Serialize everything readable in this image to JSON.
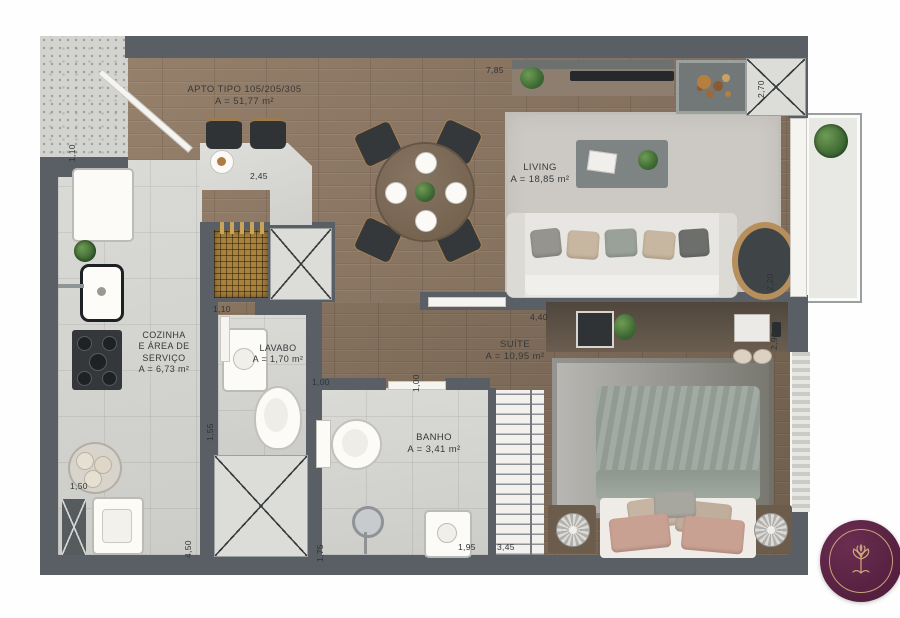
{
  "unit_label": {
    "title": "APTO TIPO 105/205/305",
    "area": "A = 51,77 m²"
  },
  "rooms": {
    "living": {
      "name": "LIVING",
      "area": "A = 18,85 m²"
    },
    "cozinha": {
      "name_line1": "COZINHA",
      "name_line2": "E ÁREA DE",
      "name_line3": "SERVIÇO",
      "area": "A = 6,73 m²"
    },
    "lavabo": {
      "name": "LAVABO",
      "area": "A = 1,70 m²"
    },
    "banho": {
      "name": "BANHO",
      "area": "A = 3,41 m²"
    },
    "suite": {
      "name": "SUÍTE",
      "area": "A = 10,95 m²"
    }
  },
  "dimensions": {
    "top_width": "7,85",
    "fire_nook_depth": "2,70",
    "entry_width": "1,10",
    "counter_length": "2,45",
    "lavabo_door": "1,10",
    "hall_length": "4,40",
    "living_right": "2,20",
    "suite_right": "2,90",
    "banho_door_a": "1,00",
    "banho_door_b": "1,00",
    "lavabo_depth": "1,55",
    "service_width": "1,50",
    "kitchen_length": "4,50",
    "banho_width": "1,75",
    "banho_length": "1,95",
    "closet_length": "3,45"
  },
  "logo": {
    "icon": "tree-emblem-icon"
  },
  "colors": {
    "wall": "#595f64",
    "wood": "#8b7663",
    "wood_dark": "#7d6a58",
    "tile": "#d4d4d0",
    "label_text": "#36393b",
    "logo_bg": "#55203f",
    "logo_gold": "#c9a27a"
  }
}
